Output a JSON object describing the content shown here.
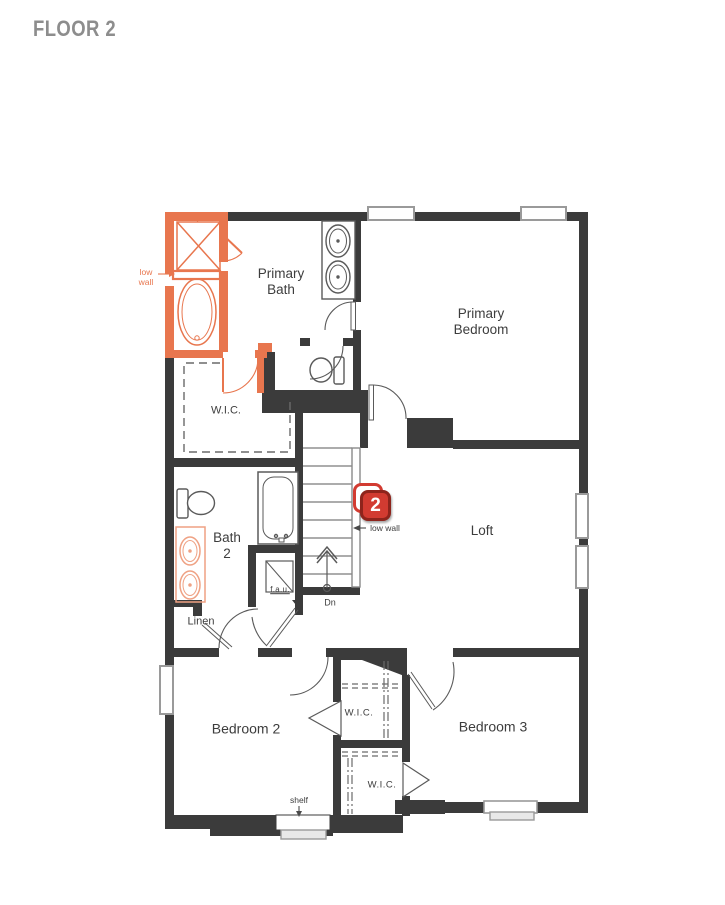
{
  "header": {
    "title": "FLOOR 2"
  },
  "badge": {
    "number": "2"
  },
  "rooms": {
    "primary_bath": {
      "label": "Primary Bath"
    },
    "primary_bedroom": {
      "label": "Primary Bedroom"
    },
    "primary_wic": {
      "label": "W.I.C."
    },
    "bath_2": {
      "label": "Bath 2"
    },
    "loft": {
      "label": "Loft"
    },
    "linen": {
      "label": "Linen"
    },
    "bedroom_2": {
      "label": "Bedroom 2"
    },
    "bedroom_3": {
      "label": "Bedroom 3"
    },
    "wic_bedroom_2": {
      "label": "W.I.C."
    },
    "wic_bedroom_3": {
      "label": "W.I.C."
    }
  },
  "annotations": {
    "low_wall_bath": "low wall",
    "low_wall_stairs": "low wall",
    "stairs_direction": "Dn",
    "fau": "f.a.u.",
    "shelf": "shelf"
  },
  "colors": {
    "wall": "#3b3b3b",
    "accent_orange": "#e8764e",
    "vanity_salmon": "#efa183",
    "badge_red": "#d23b31",
    "badge_border": "#8e241c",
    "label_text": "#3d3d3d",
    "title_gray": "#8d8d8d",
    "window_gray": "#9a9a9a",
    "fixture_gray": "#5a5a5a"
  }
}
